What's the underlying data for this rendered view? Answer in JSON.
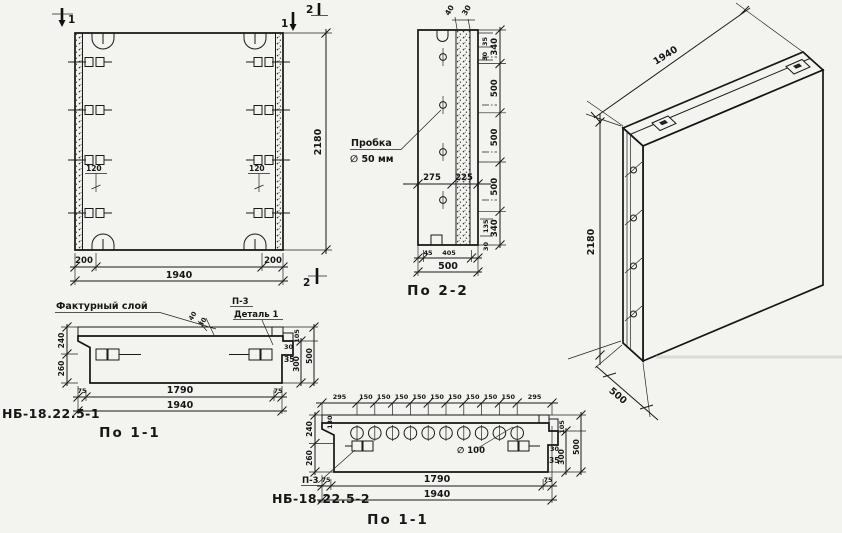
{
  "drawing": {
    "front_view": {
      "cut_label_1": "1",
      "cut_label_2": "2",
      "dims": {
        "height": "2180",
        "width": "1940",
        "edge_left": "200",
        "edge_right": "200",
        "anchor_left": "120",
        "anchor_right": "120"
      }
    },
    "section_2_2": {
      "title": "По 2-2",
      "plug_note": {
        "line1": "Пробка",
        "line2": "∅ 50 мм"
      },
      "dims": {
        "top": [
          "40",
          "30"
        ],
        "top_side": [
          "35",
          "30"
        ],
        "right": [
          "340",
          "500",
          "500",
          "500",
          "340"
        ],
        "mid": [
          "275",
          "225"
        ],
        "bottom": [
          "45",
          "405"
        ],
        "bottom_total": "500",
        "bottom_side": [
          "135",
          "30"
        ]
      }
    },
    "iso_view": {
      "dims": {
        "width": "1940",
        "height": "2180",
        "thickness": "500"
      }
    },
    "section_1_1_a": {
      "mark": "НБ-18.22.5-1",
      "title": "По 1-1",
      "facing_layer_label": "Фактурный слой",
      "detail_note": {
        "line1": "П-3",
        "line2": "Деталь 1"
      },
      "dims": {
        "left": [
          "240",
          "260"
        ],
        "layer": [
          "40",
          "30"
        ],
        "right_small": [
          "30",
          "35"
        ],
        "right": [
          "105",
          "300",
          "500"
        ],
        "bottom": [
          "75",
          "1790",
          "75"
        ],
        "bottom_total": "1940"
      }
    },
    "section_1_1_b": {
      "mark": "НБ-18.22.5-2",
      "title": "По 1-1",
      "detail_note": "П-3",
      "hole_note": "∅ 100",
      "dims": {
        "top": [
          "295",
          "150",
          "150",
          "150",
          "150",
          "150",
          "150",
          "150",
          "150",
          "150",
          "295"
        ],
        "left": [
          "240",
          "260"
        ],
        "left_small": "130",
        "right_small": [
          "30",
          "35"
        ],
        "right": [
          "105",
          "300",
          "500"
        ],
        "bottom": [
          "75",
          "1790",
          "75"
        ],
        "bottom_total": "1940"
      }
    }
  }
}
